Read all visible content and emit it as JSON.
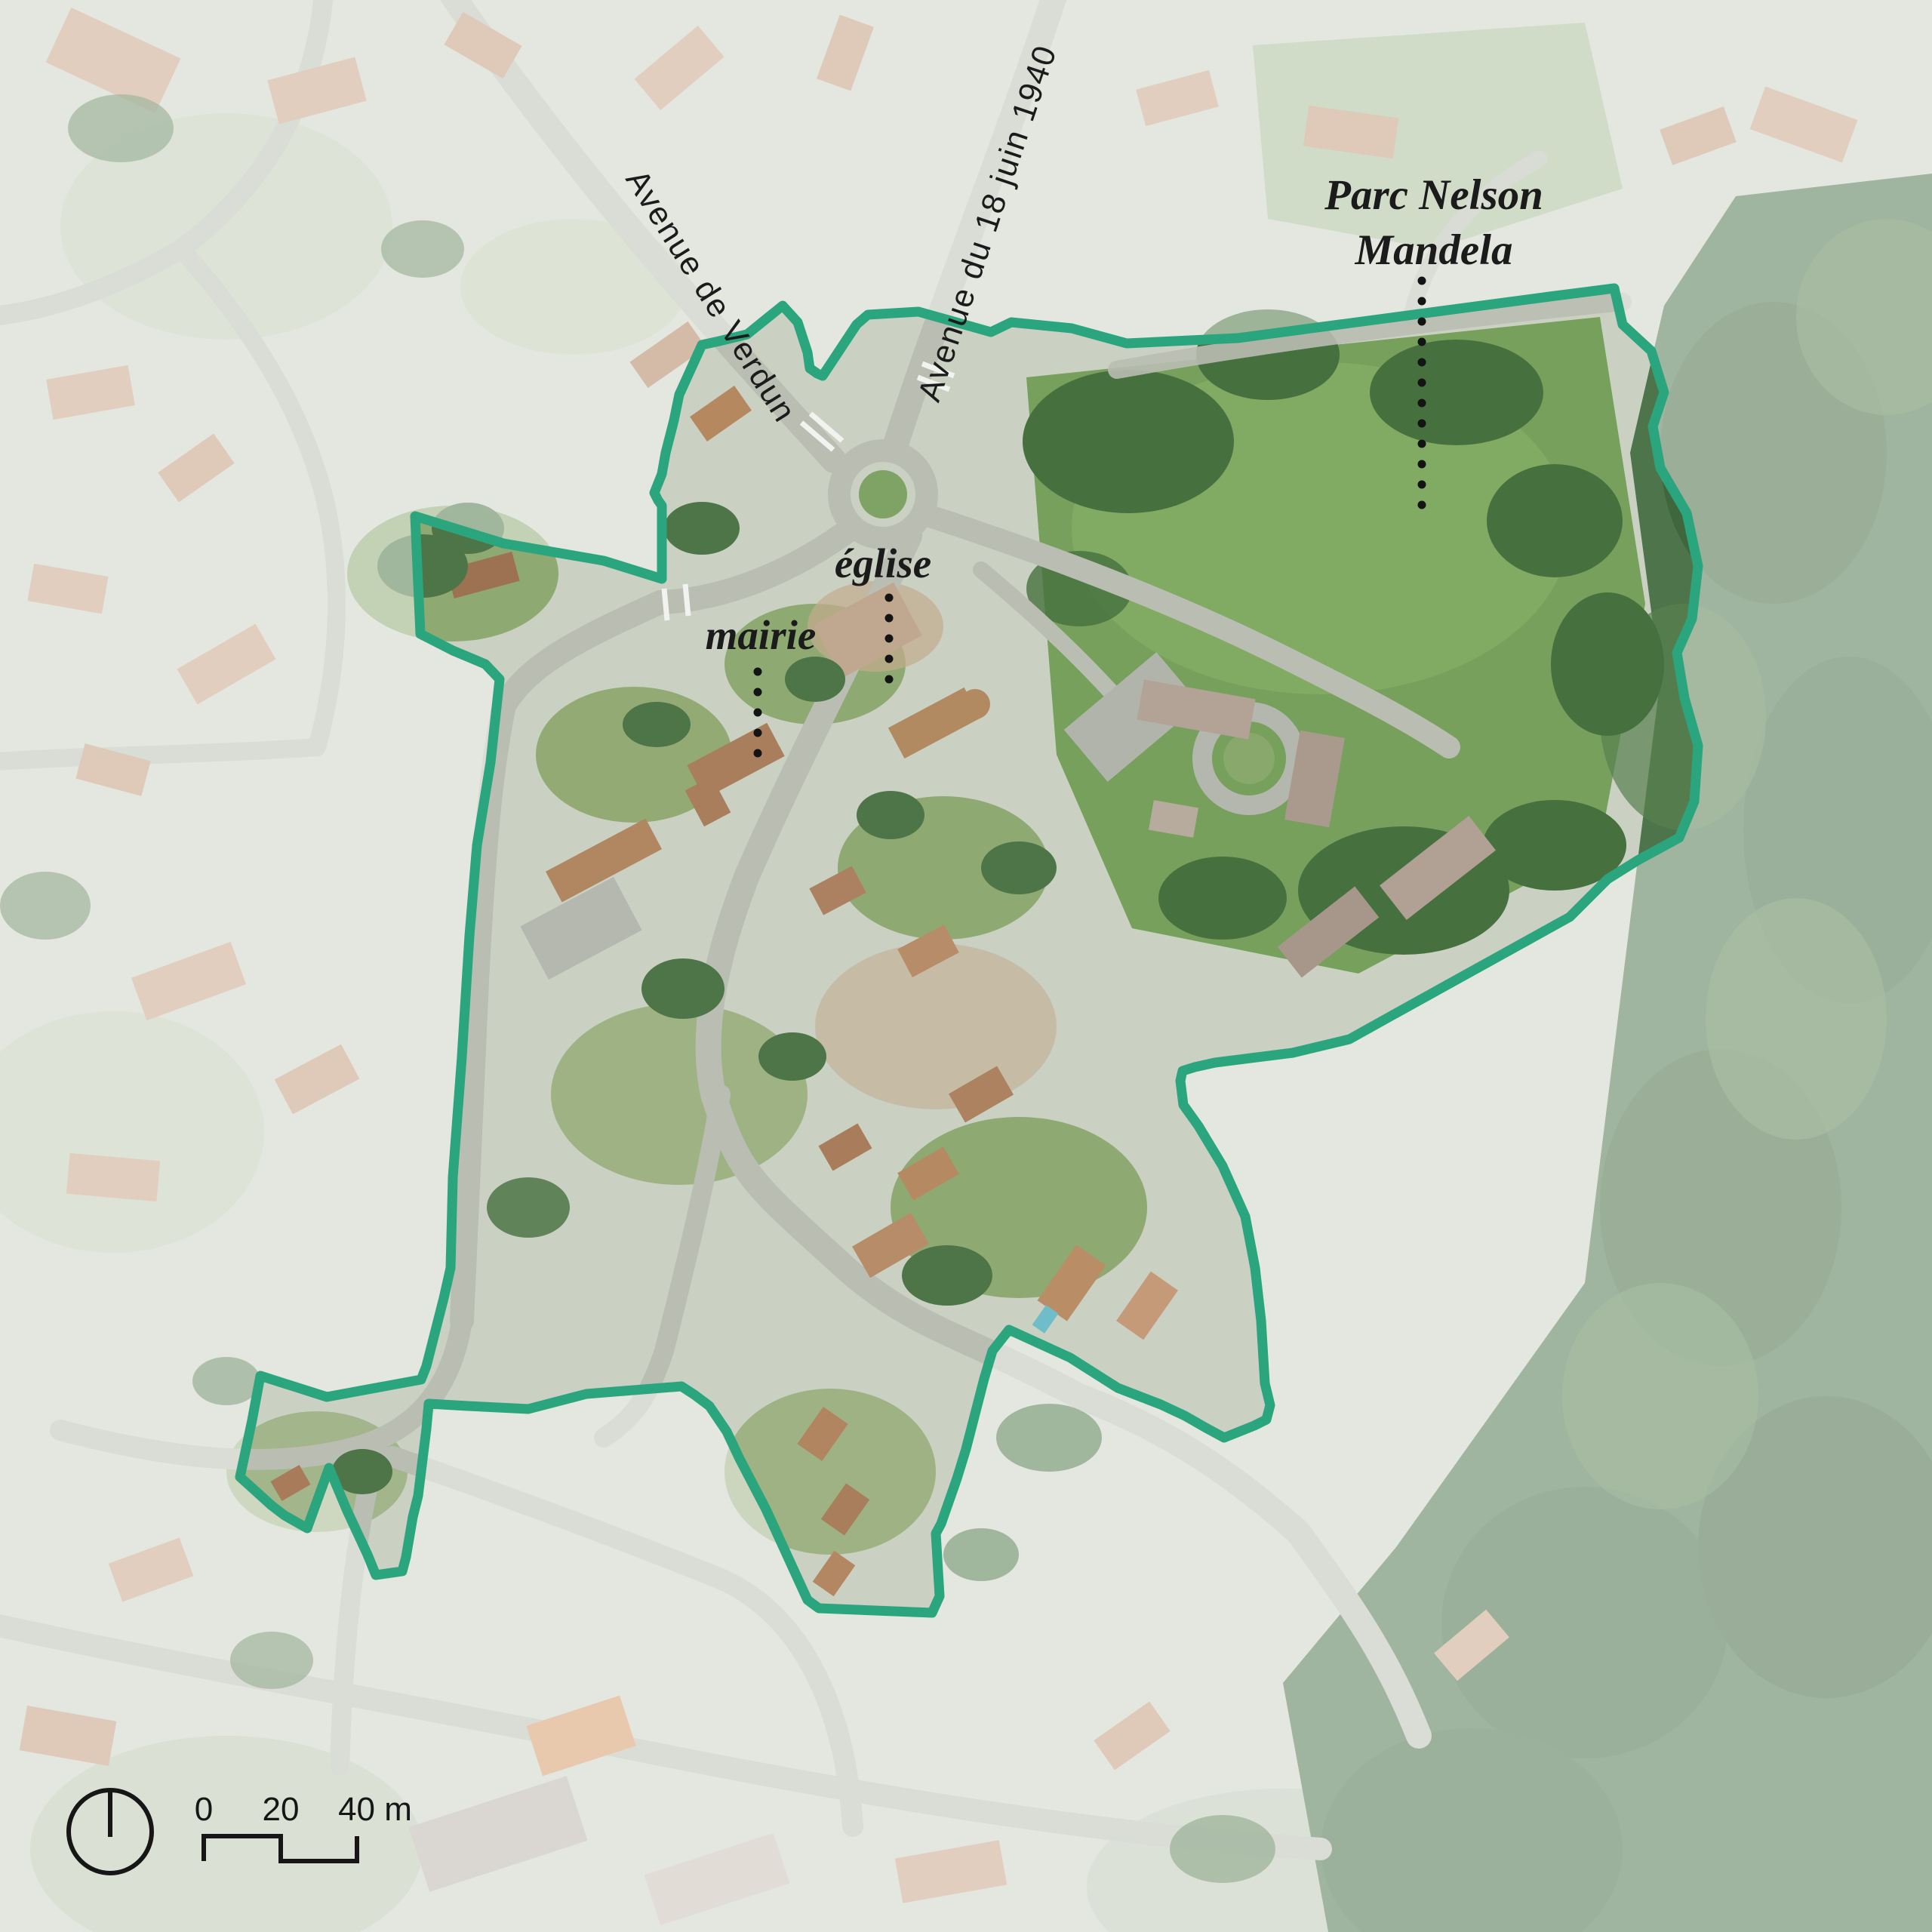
{
  "map": {
    "title": "aerial study-area map",
    "street_labels": [
      {
        "text": "Avenue de Verdun"
      },
      {
        "text": "Avenue du 18 juin 1940"
      }
    ],
    "place_labels": {
      "park_line1": "Parc Nelson",
      "park_line2": "Mandela",
      "church": "église",
      "town_hall": "mairie"
    },
    "scale_bar": {
      "label_0": "0",
      "label_20": "20",
      "label_40": "40 m"
    },
    "colors": {
      "boundary": "#2aa57d",
      "label": "#1b1b1b",
      "forest": "#4d744a",
      "meadow": "#76a05b",
      "road": "#b9bdb2",
      "roof": "#a8795a"
    }
  }
}
